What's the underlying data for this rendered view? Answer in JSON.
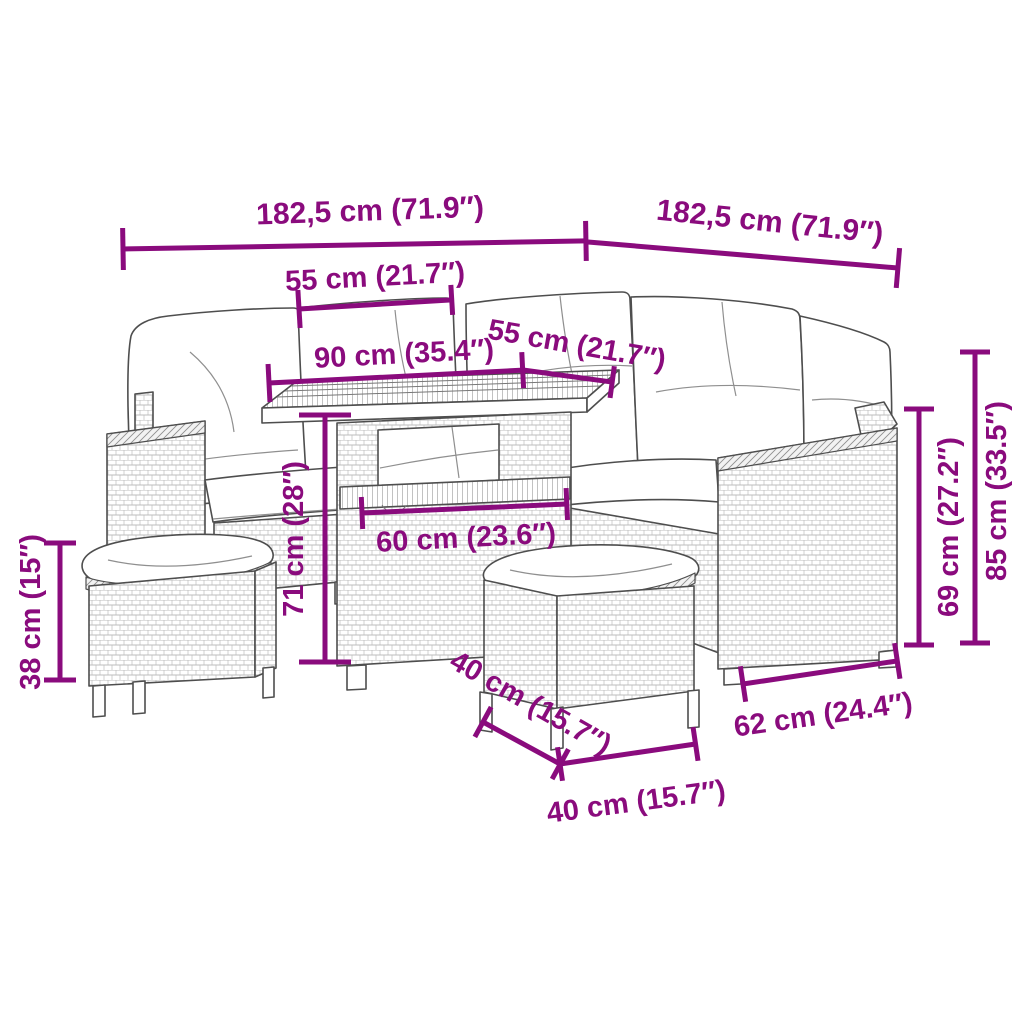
{
  "diagram": {
    "type": "product-dimension-diagram",
    "subject": "rattan garden lounge set with corner sofa, dining table and two stools"
  },
  "style": {
    "dimension_color": "#8A0B7D",
    "artwork_line_color": "#4E4E4E",
    "background": "#FFFFFF"
  },
  "dim_labels": {
    "overall_left": "182,5 cm (71.9″)",
    "overall_right": "182,5 cm (71.9″)",
    "seat_section_left": "55 cm (21.7″)",
    "table_top_length": "90 cm (35.4″)",
    "seat_section_right": "55 cm (21.7″)",
    "table_height": "71 cm (28″)",
    "table_top_width": "60 cm (23.6″)",
    "stool_height": "38 cm (15″)",
    "stool_depth": "40 cm (15.7″)",
    "stool_width": "40 cm (15.7″)",
    "armrest_section_depth": "62 cm (24.4″)",
    "backrest_height": "69 cm (27.2″)",
    "overall_height": "85 cm (33.5″)"
  }
}
